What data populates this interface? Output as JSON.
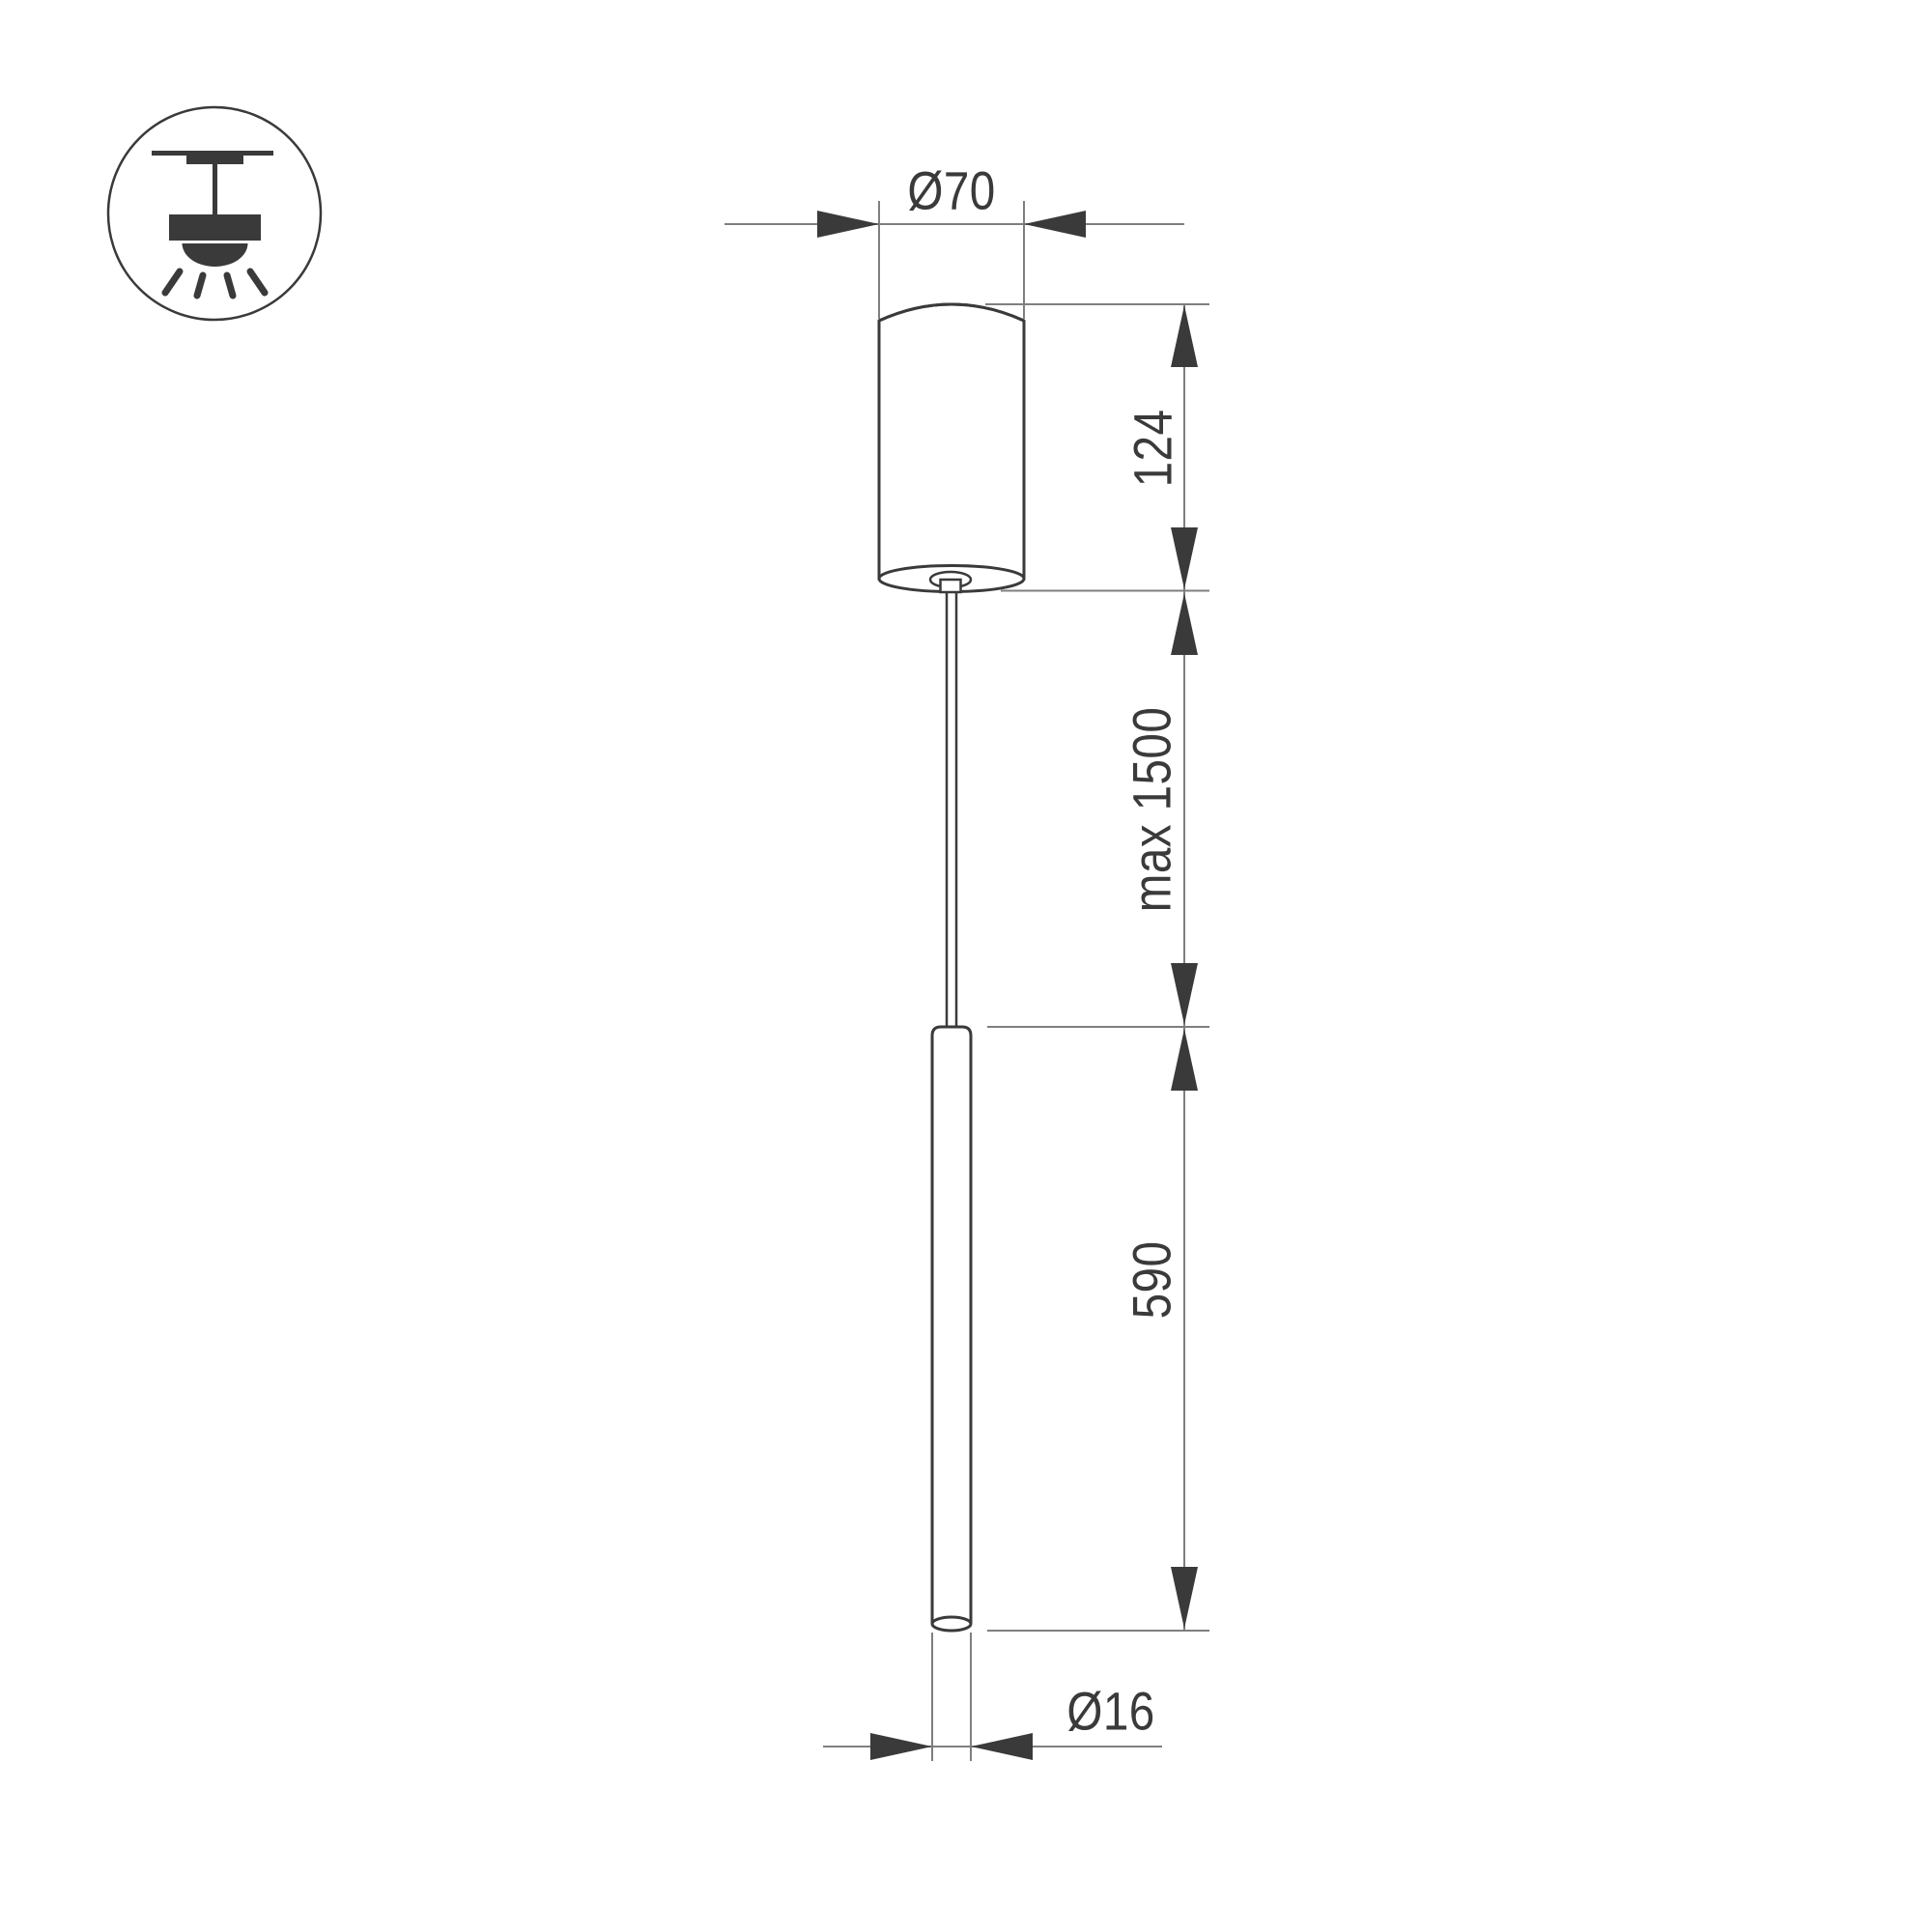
{
  "drawing": {
    "kind": "pendant-lamp-dimension-drawing"
  },
  "icon": {
    "name": "ceiling-pendant-light-icon"
  },
  "dimensions": {
    "canopy_diameter": {
      "label": "Ø70",
      "value": 70
    },
    "canopy_height": {
      "label": "124",
      "value": 124
    },
    "suspension_length": {
      "label": "max 1500",
      "value": 1500
    },
    "tube_length": {
      "label": "590",
      "value": 590
    },
    "tube_diameter": {
      "label": "Ø16",
      "value": 16
    }
  },
  "colors": {
    "background": "#ffffff",
    "outline": "#3a3a3a",
    "dimension": "#7f7f7f",
    "arrow": "#3a3a3a",
    "text": "#3a3a3a"
  }
}
